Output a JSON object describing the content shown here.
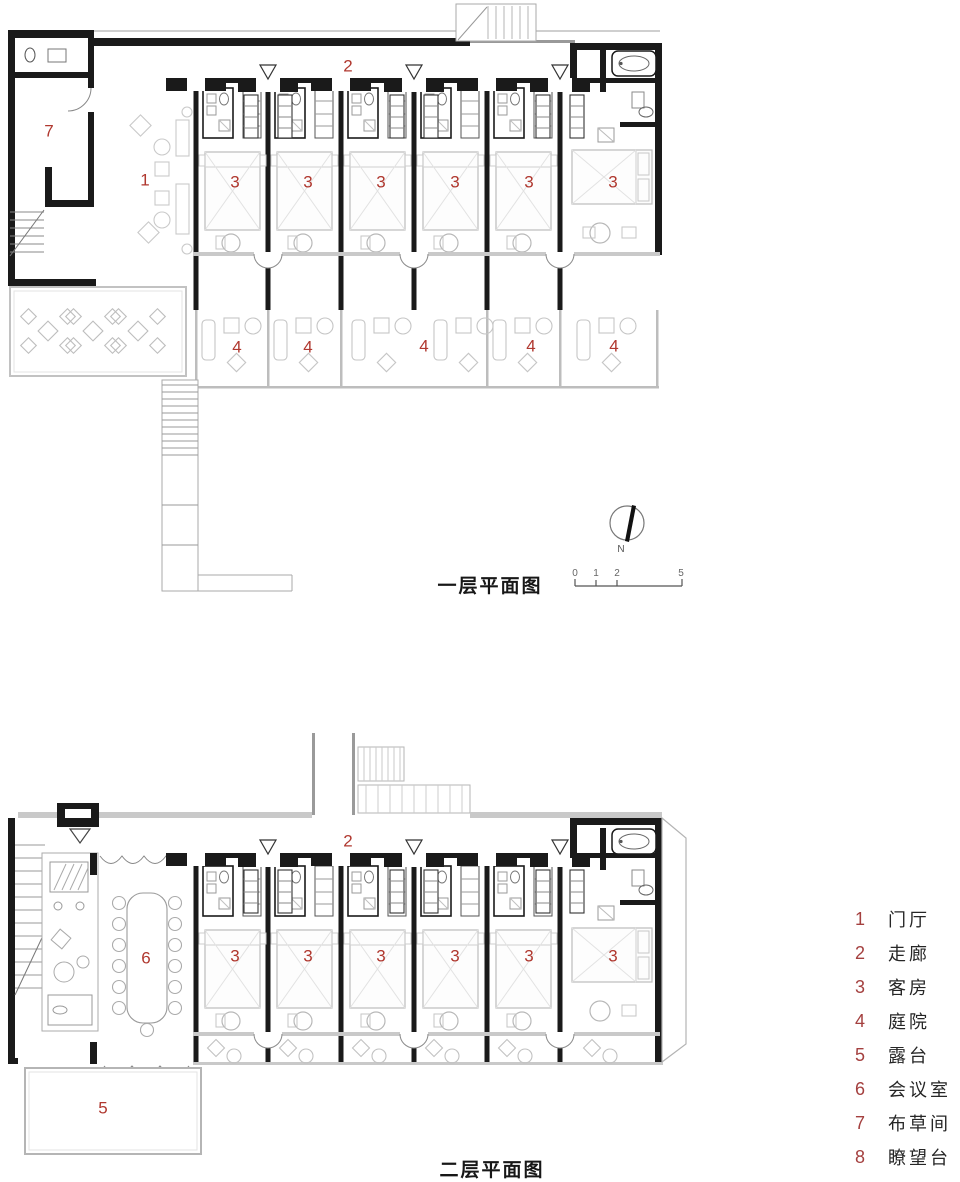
{
  "plan1": {
    "title": "一层平面图",
    "room_labels": {
      "lobby": "1",
      "corridor": "2",
      "guest": "3",
      "courtyard": "4",
      "linen": "7"
    }
  },
  "plan2": {
    "title": "二层平面图",
    "room_labels": {
      "corridor": "2",
      "guest": "3",
      "terrace": "5",
      "meeting": "6"
    }
  },
  "north_indicator": {
    "label": "N"
  },
  "scale_bar": {
    "ticks": [
      "0",
      "1",
      "2",
      "5"
    ]
  },
  "legend": {
    "items": [
      {
        "num": "1",
        "label": "门厅"
      },
      {
        "num": "2",
        "label": "走廊"
      },
      {
        "num": "3",
        "label": "客房"
      },
      {
        "num": "4",
        "label": "庭院"
      },
      {
        "num": "5",
        "label": "露台"
      },
      {
        "num": "6",
        "label": "会议室"
      },
      {
        "num": "7",
        "label": "布草间"
      },
      {
        "num": "8",
        "label": "瞭望台"
      }
    ]
  },
  "colors": {
    "label_red": "#b0382f",
    "legend_number_red": "#a4403f",
    "wall_black": "#1a1a1a",
    "light_gray": "#c9c9c9",
    "text_dark": "#262626",
    "background": "#ffffff"
  }
}
